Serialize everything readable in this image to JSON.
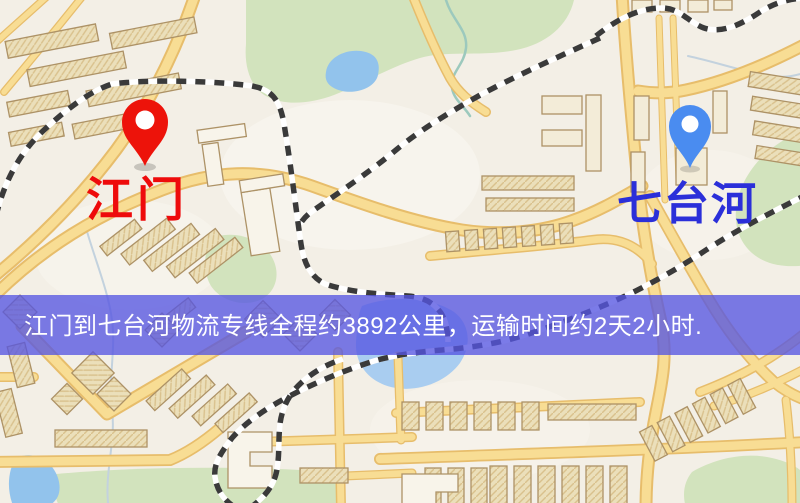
{
  "banner": {
    "text": "江门到七台河物流专线全程约3892公里，运输时间约2天2小时.",
    "bg_color": "#5656e2",
    "text_color": "#ffffff"
  },
  "route": {
    "origin": "江门",
    "destination": "七台河",
    "distance_text": "约3892公里",
    "duration_text": "约2天2小时"
  },
  "markers": {
    "origin": {
      "label": "江门",
      "pin_color": "#ed130a",
      "label_color": "#ee0b0b"
    },
    "destination": {
      "label": "七台河",
      "pin_color": "#4a8cf0",
      "label_color": "#2b2fd9"
    }
  },
  "map_palette": {
    "land": "#f3efe6",
    "road_fill": "#f8dd94",
    "road_casing": "#e7bd6b",
    "building": "#ebdfba",
    "green": "#d2e3bd",
    "water": "#92c3ec",
    "railway": "#3a3a3a"
  }
}
